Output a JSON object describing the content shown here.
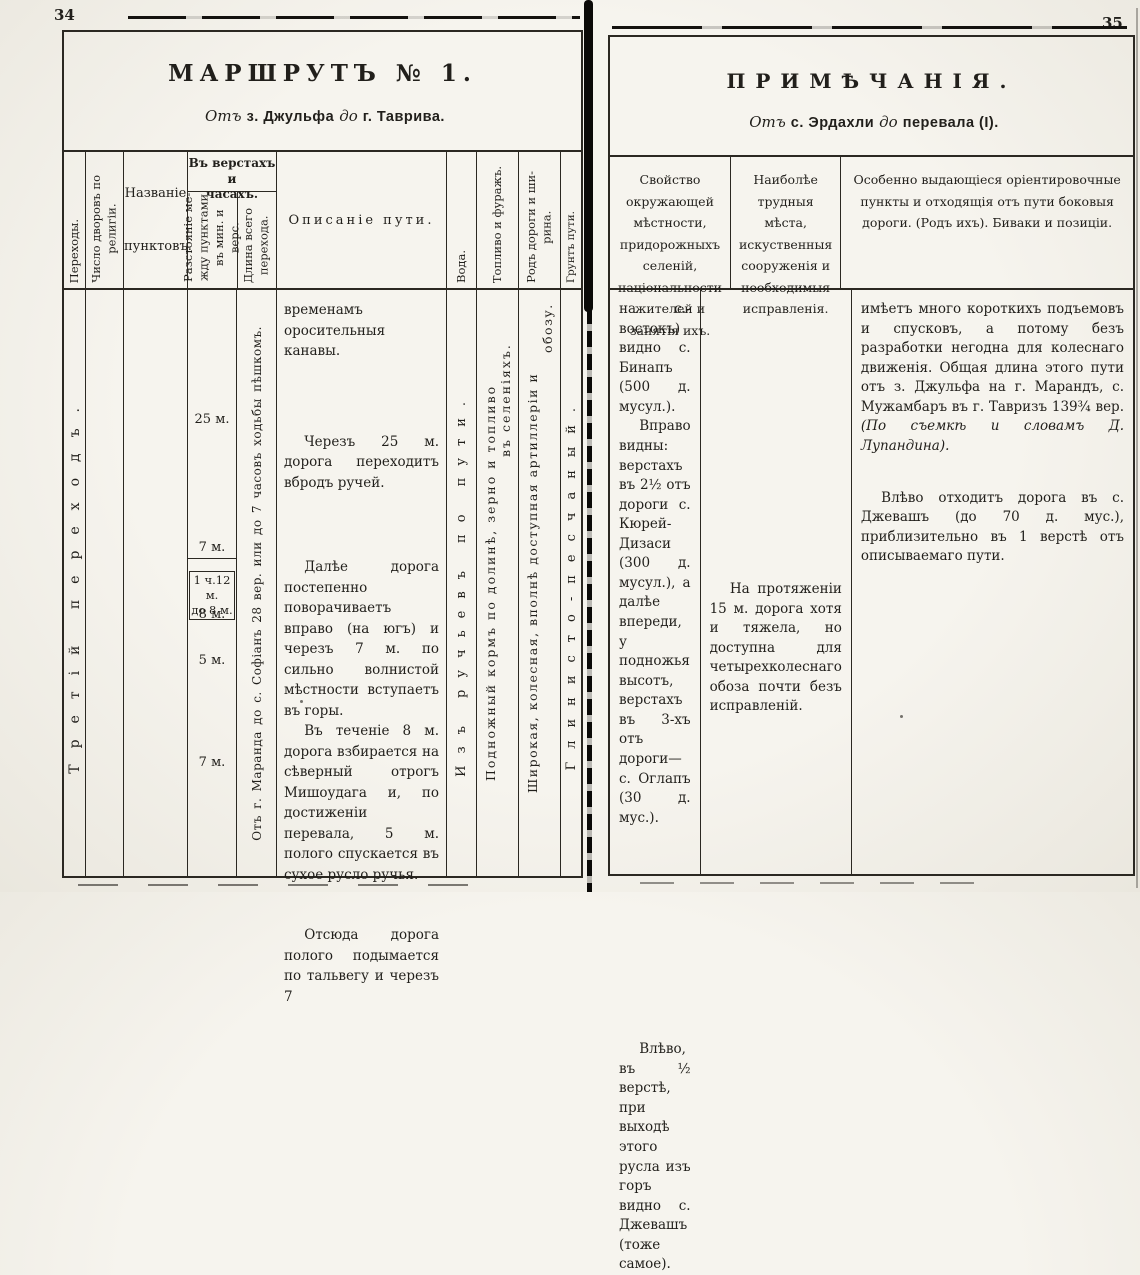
{
  "scan": {
    "page_number_left": "34",
    "page_number_right": "35",
    "colors": {
      "paper": "#f5f3ed",
      "ink": "#211f1b",
      "border": "#2b2822"
    }
  },
  "route_table": {
    "title": "МАРШРУТЪ № 1.",
    "subtitle": {
      "ot": "Отъ",
      "from": "з. Джульфа",
      "do": "до",
      "to": "г. Таврива."
    },
    "headers": {
      "perekhody": "Переходы.",
      "dvory_lines": [
        "Число дворовъ по",
        "религіи."
      ],
      "nazvanie_lines": [
        "Названіе",
        "пунктовъ."
      ],
      "versty_group_lines": [
        "Въ верстахъ и",
        "часахъ."
      ],
      "rasstoyanie_lines": [
        "Разстояніе ме-",
        "жду пунктами",
        "въ мин. и верс."
      ],
      "dlina_lines": [
        "Длина всего",
        "перехода."
      ],
      "opisanie": "Описаніе пути.",
      "voda": "Вода.",
      "toplivo": "Топливо и фуражъ.",
      "rod_dorogi_lines": [
        "Родъ дороги и ши-",
        "рина."
      ],
      "grunt": "Грунтъ пути."
    },
    "body": {
      "perekhod": "Третій переходъ.",
      "dlina_note": "Отъ г. Маранда до с. Софіанъ 28 вер. или до 7 часовъ ходьбы пѣшкомъ.",
      "distances": {
        "d1": "25 м.",
        "d2": "7 м.",
        "d3_line1": "1 ч.12 м.",
        "d3_line2": "до 8 м.",
        "d4": "8 м.",
        "d5": "5 м.",
        "d6": "7 м."
      },
      "opisanie_paragraphs": [
        "временамъ оросительныя канавы.",
        "Черезъ 25 м. дорога переходитъ вбродъ ручей.",
        "Далѣе дорога постепенно поворачиваетъ вправо (на югъ) и черезъ 7 м. по сильно волнистой мѣстности вступаетъ въ горы.",
        "Въ теченіе 8 м. дорога взбирается на сѣверный отрогъ Мишоудага и, по достиженіи перевала, 5 м. полого спускается въ сухое русло ручья.",
        "Отсюда дорога полого подымается по тальвегу и черезъ 7"
      ],
      "voda": "Изъ ручьевъ по пути.",
      "toplivo_lines": [
        "Подножный кормъ по долинѣ, зерно и топливо",
        "въ селеніяхъ."
      ],
      "rod_dorogi_lines": [
        "Широкая, колесная, вполнѣ доступная артиллеріи и",
        "обозу."
      ],
      "grunt": "Глинисто-песчаный."
    }
  },
  "notes_table": {
    "title": "ПРИМѢЧАНІЯ.",
    "subtitle": {
      "ot": "Отъ",
      "from": "с. Эрдахли",
      "do": "до",
      "to": "перевала (I)."
    },
    "headers": {
      "col1": "Свойство окружающей мѣстности, придорожныхъ селеній, національности жителей и занятія ихъ.",
      "col2": "Наиболѣе трудныя мѣста, искуственныя сооруженія и необходимыя исправленія.",
      "col3": "Особенно выдающіеся оріентировочные пункты и отходящія отъ пути боковыя дороги. (Родъ ихъ). Биваки и позиціи."
    },
    "col1_paragraphs": {
      "p1": "на с.-востокъ) видно с. Бинапъ (500 д. мусул.).",
      "p2": "Вправо видны: верстахъ въ 2½ отъ дороги с. Кюрей-Дизаси (300 д. мусул.), а далѣе впереди, у подножья высотъ, верстахъ въ 3-хъ отъ дороги—с. Оглапъ (30 д. мус.).",
      "p3": "Влѣво, въ ½ верстѣ, при выходѣ этого русла изъ горъ видно с. Джевашъ (тоже самое)."
    },
    "col2_paragraphs": {
      "p1": "На протяженіи 15 м. дорога хотя и тяжела, но доступна для четырехколеснаго обоза почти безъ исправленій."
    },
    "col3_paragraphs": {
      "p1_main": "имѣетъ много короткихъ подъемовъ и спусковъ, а потому безъ разработки негодна для колеснаго движенія. Общая длина этого пути отъ з. Джульфа на г. Марандъ, с. Мужамбаръ въ г. Тавризъ 139¾ вер. ",
      "p1_italic": "(По съемкѣ и словамъ Д. Лупандина).",
      "p2": "Влѣво отходитъ дорога въ с. Джевашъ (до 70 д. мус.), приблизительно въ 1 верстѣ отъ описываемаго пути."
    }
  }
}
